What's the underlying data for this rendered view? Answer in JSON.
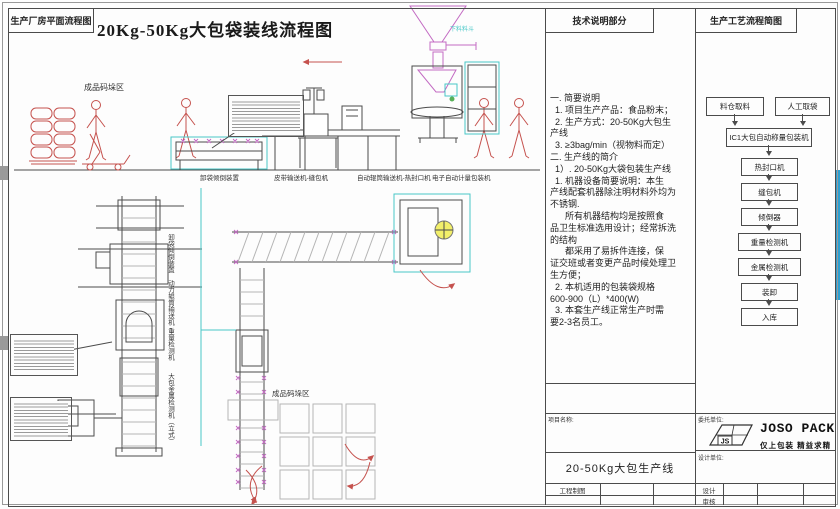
{
  "sheet": {
    "area_label": "生产厂房平面流程图",
    "main_title": "20Kg-50Kg大包袋装线流程图"
  },
  "drawing": {
    "stack_area_top_label": "成品码垛区",
    "stack_area_bottom_label": "成品码垛区",
    "hopper_label": "下料料斗",
    "line_labels": [
      "卸袋倾倒装置",
      "皮带输送机-缝包机",
      "自动辊筒输送机-热封口机",
      "电子自动计量包装机"
    ],
    "vertical_labels": [
      "卸袋倾倒装置",
      "动力辊筒输送机",
      "重量检测机",
      "大包金属检测机（立式）"
    ]
  },
  "tech_notes": {
    "header": "技术说明部分",
    "lines": [
      "一. 简要说明",
      "  1. 项目生产产品：食品粉末；",
      "  2. 生产方式：20-50Kg大包生",
      "产线",
      "  3. ≥3bag/min（视物料而定）",
      "二. 生产线的简介",
      "  1）. 20-50Kg大袋包装生产线",
      "  1. 机器设备简要说明：本生",
      "产线配套机器除注明材料外均为",
      "不锈钢.",
      "      所有机器结构均是按照食",
      "品卫生标准选用设计；经常拆洗",
      "的结构",
      "      都采用了易拆件连接，保",
      "证交班或者变更产品时候处理卫",
      "生方便；",
      "  2. 本机适用的包装袋规格",
      "600-900（L）*400(W)",
      "  3. 本套生产线正常生产时需",
      "要2-3名员工。"
    ]
  },
  "process_chart": {
    "header": "生产工艺流程简图",
    "nodes": [
      "料仓取料",
      "人工取袋",
      "IC1大包自动称量包装机",
      "热封口机",
      "缝包机",
      "倾倒器",
      "重量检测机",
      "金属检测机",
      "装卸",
      "入库"
    ]
  },
  "title_block": {
    "client_label": "委托单位:",
    "designer_label": "设计单位:",
    "brand": "JOSO PACK",
    "slogan": "仅上包装 精益求精",
    "logo_text": "JS",
    "project_label": "项目名称:",
    "project_name": "20-50Kg大包生产线",
    "drafting_label": "工程制图",
    "row_design": "设计",
    "row_review": "审核"
  },
  "colors": {
    "line": "#4b4b4b",
    "red": "#c5524e",
    "magenta": "#c36bc3",
    "cyan": "#49c8c8",
    "yellow": "#f2ef6a",
    "edge_blue": "#2e9fd0"
  }
}
